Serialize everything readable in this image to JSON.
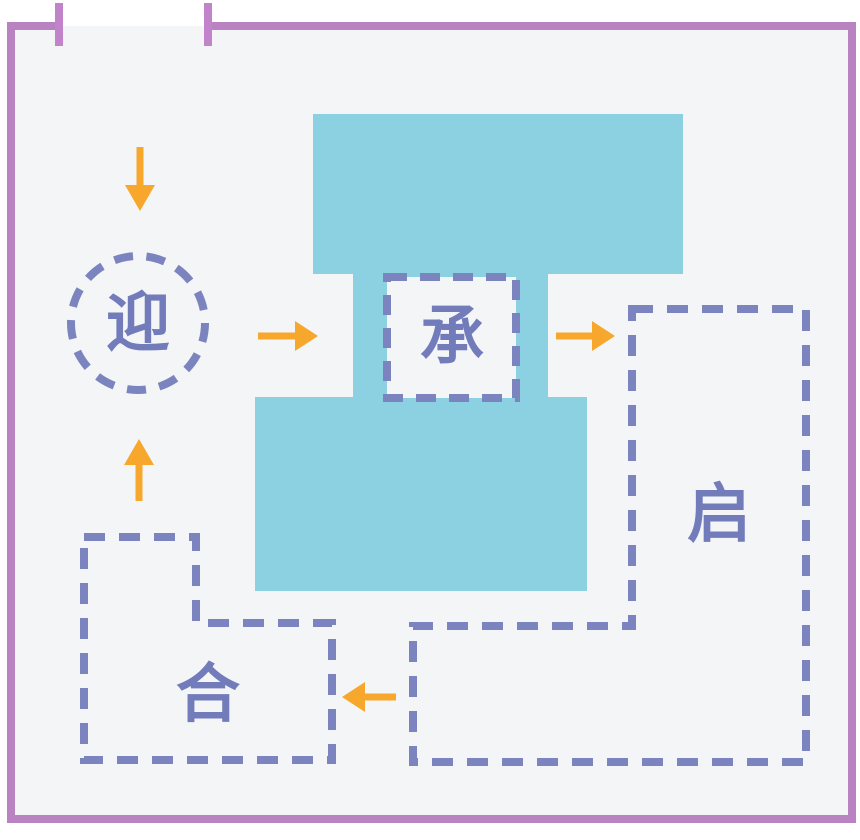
{
  "diagram": {
    "type": "floor-plan-concept-diagram",
    "description": "spatial sequence diagram with door opening, building mass and dashed program zones linked by arrows",
    "nodes": {
      "welcome": {
        "label": "迎",
        "shape": "dashed-circle",
        "position": "left"
      },
      "receive": {
        "label": "承",
        "shape": "dashed-square",
        "position": "center"
      },
      "open": {
        "label": "启",
        "shape": "dashed-l-polygon",
        "position": "right"
      },
      "unite": {
        "label": "合",
        "shape": "dashed-step-polygon",
        "position": "bottom-left"
      }
    },
    "arrows": [
      {
        "id": "entry-down",
        "direction": "down",
        "from": "door-opening",
        "to": "welcome"
      },
      {
        "id": "welcome-to-receive",
        "direction": "right",
        "from": "welcome",
        "to": "receive"
      },
      {
        "id": "receive-to-open",
        "direction": "right",
        "from": "receive",
        "to": "open"
      },
      {
        "id": "open-to-unite",
        "direction": "left",
        "from": "open",
        "to": "unite"
      },
      {
        "id": "unite-to-welcome",
        "direction": "up",
        "from": "unite",
        "to": "welcome"
      }
    ],
    "wall": {
      "door_opening": "top-left"
    }
  },
  "colors": {
    "page_bg": "#ffffff",
    "room_fill": "#f4f5f7",
    "wall": "#b983c2",
    "door_jamb": "#c183c9",
    "mass_fill": "#8bd1e2",
    "outline": "#7b84be",
    "label_text": "#737cbb",
    "arrow": "#f7a72c"
  }
}
